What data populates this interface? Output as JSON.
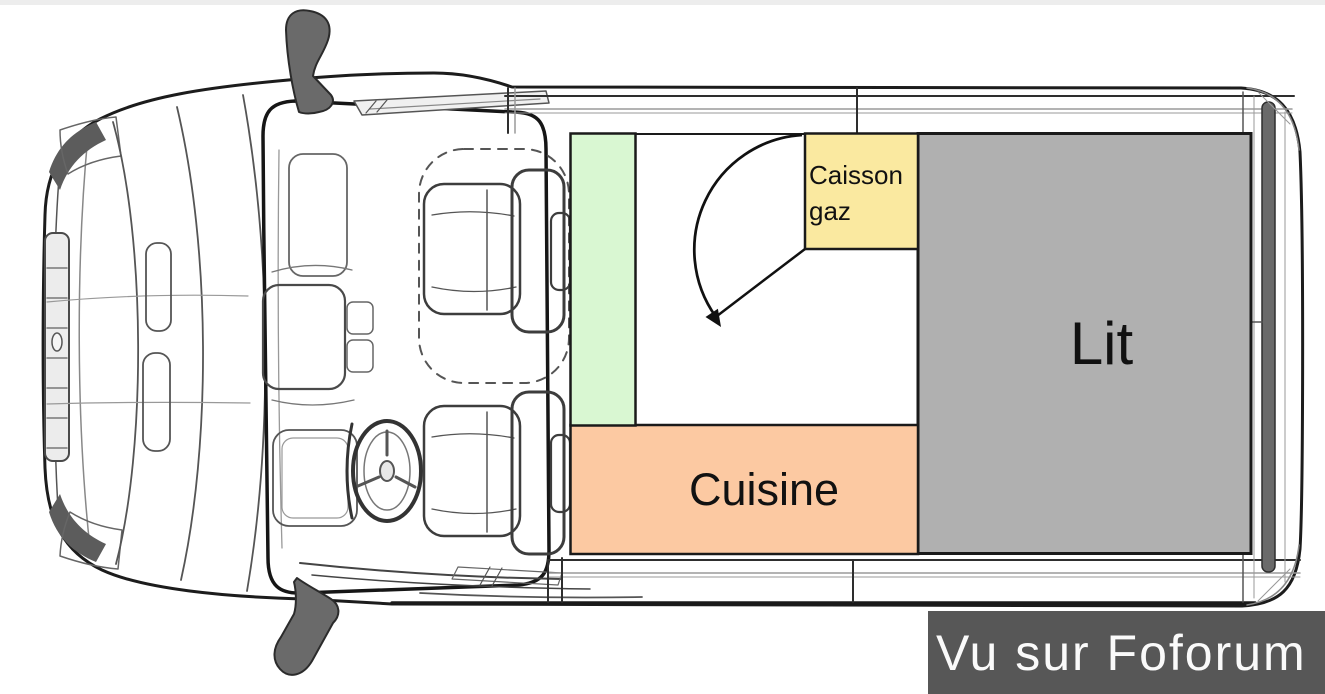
{
  "diagram": {
    "view": "van-top-view-floorplan",
    "zones": {
      "green_cabinet": {
        "color": "#d9f7d2"
      },
      "floor": {
        "color": "#ffffff"
      },
      "caisson_gaz": {
        "line1": "Caisson",
        "line2": "gaz",
        "color": "#fae9a0"
      },
      "lit": {
        "label": "Lit",
        "color": "#b0b0b0"
      },
      "cuisine": {
        "label": "Cuisine",
        "color": "#fcc9a2"
      }
    }
  },
  "watermark": {
    "text": "Vu sur Foforum",
    "background": "#575757",
    "color": "#fafafa"
  }
}
